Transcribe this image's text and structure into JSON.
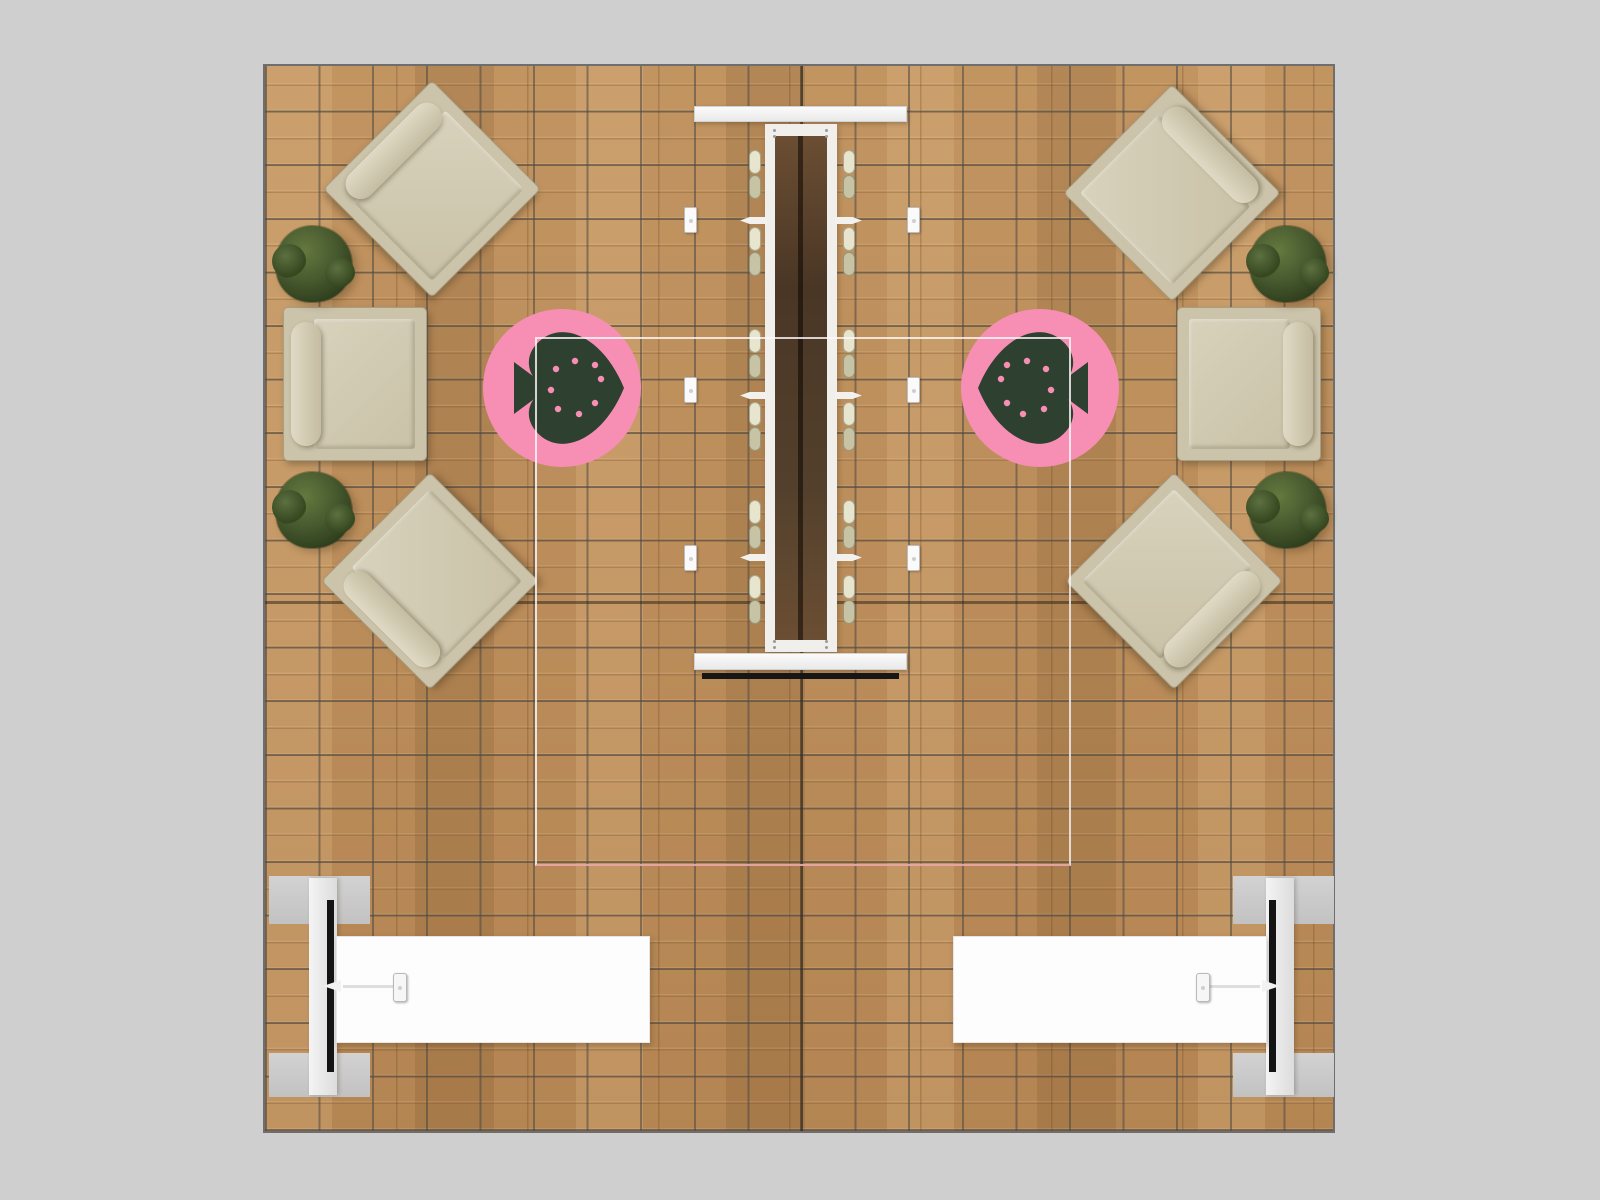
{
  "scene": {
    "title": "booth-floor-plan-top-view",
    "background_color": "#cfcfcf",
    "floor": {
      "material": "wood-plank-with-tile-grid",
      "wood_color": "#bd8d58",
      "grid_color": "#4b4842",
      "border_color": "#6e6e6e"
    },
    "rug_circles": {
      "count": 2,
      "color": "#f78fb5",
      "icon": "strawberry-heart-icon",
      "icon_color": "#2e4030",
      "orientation": "icons point toward center aisle"
    },
    "rug_outline": {
      "shape": "rectangle",
      "color": "rgba(255,250,248,0.8)",
      "accent_color": "#e8a6a2"
    },
    "lounge_chairs": {
      "corner_diagonal_count": 4,
      "side_count": 2,
      "fabric_color": "#cbc4ab",
      "cushion_color": "#d8d2bc"
    },
    "planters": {
      "count": 4,
      "foliage_color": "#3d512a"
    },
    "demo_table": {
      "cap_color": "#f4f4f4",
      "frame_color": "#f0efec",
      "well_color": "#553f29",
      "stool_color": "#e8e5cf",
      "stool_pairs_per_side": 6,
      "shelves_per_side": 3,
      "stands_per_side": 3,
      "base_strip_color": "#161616"
    },
    "media_walls": {
      "count": 2,
      "panel_color": "#e9e9e9",
      "screen_color": "#141414",
      "foot_color": "#c9c9c9"
    },
    "counters": {
      "count": 2,
      "top_color": "#fdfdfd",
      "tablet_stands": 2
    }
  }
}
